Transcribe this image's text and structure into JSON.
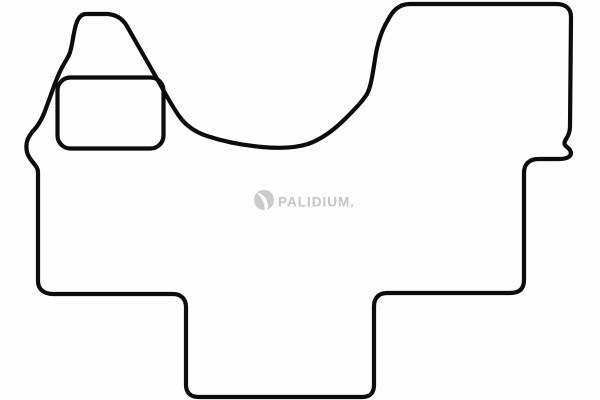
{
  "image": {
    "subject": "vehicle floor mat outline drawing",
    "background": "#fdfdfd"
  },
  "colors": {
    "outline": "#0c0c0c",
    "watermark_text": "#c5c5c5",
    "watermark_icon": "#cbcbcb",
    "watermark_icon_highlight": "#ffffff"
  },
  "watermark": {
    "brand_text": "PALIDIUM.",
    "icon": "sphere-swoosh-icon"
  }
}
